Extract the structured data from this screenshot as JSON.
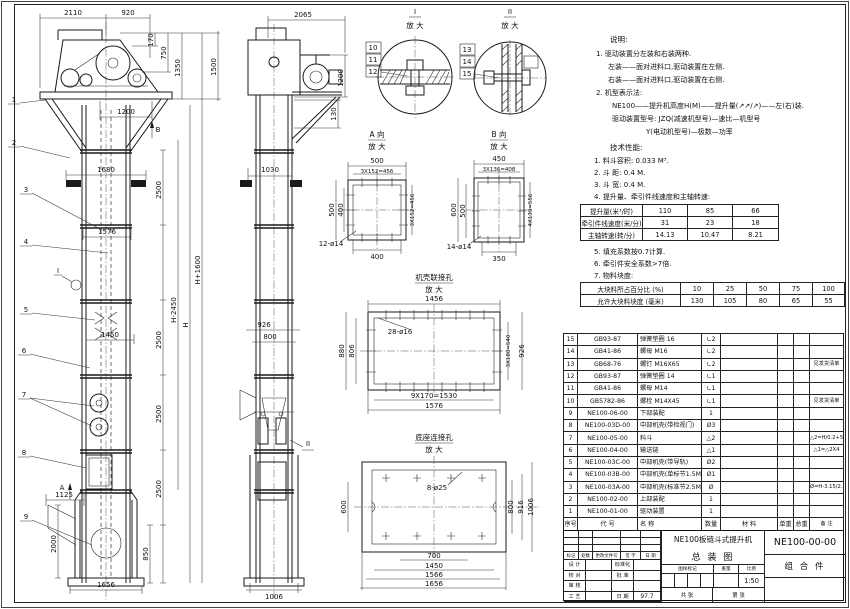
{
  "dims": {
    "d2110": "2110",
    "d920": "920",
    "d170": "170",
    "d750": "750",
    "d1350": "1350",
    "d1500": "1500",
    "d1200": "1200",
    "d1680": "1680",
    "d1576": "1576",
    "d1450": "1450",
    "d2500": "2500",
    "dHp": "H+1600",
    "dHm": "H-2450",
    "dH": "H",
    "d1125": "1125",
    "d2000": "2000",
    "d850": "850",
    "d1656": "1656",
    "d2065": "2065",
    "d130": "130",
    "d1030": "1030",
    "d926": "926",
    "d800": "800",
    "d1006": "1006",
    "d500": "500",
    "d456": "3X152=456",
    "d400": "400",
    "d12h": "12-ø14",
    "d450": "450",
    "d408": "3X136=408",
    "d600": "600",
    "d556": "4X139=556",
    "d350": "350",
    "d14h": "14-ø14",
    "d1456": "1456",
    "d28h": "28-ø16",
    "d880": "880",
    "d806": "806",
    "d540": "3X180=540",
    "d1530": "9X170=1530",
    "d8h": "8-ø25",
    "d916": "916",
    "d700": "700",
    "d1566": "1566"
  },
  "labels": {
    "enlarge": "放 大",
    "view_a": "A 向",
    "view_b": "B 向",
    "det1": "I",
    "det2": "II",
    "joint": "机壳联接孔",
    "base": "底座连接孔",
    "mark_a": "A",
    "mark_b": "B",
    "mark_i": "I",
    "mark_ii": "II"
  },
  "balloons": [
    "1",
    "2",
    "3",
    "4",
    "5",
    "6",
    "7",
    "8",
    "9",
    "10",
    "11",
    "12",
    "13",
    "14",
    "15"
  ],
  "notes": {
    "heading": "说明:",
    "lines": [
      "1. 驱动装置分左装和右装两种.",
      "左装——面对进料口,驱动装置在左侧.",
      "右装——面对进料口,驱动装置在右侧.",
      "2. 机型表示法:",
      "NE100——提升机高度H(M)——提升量(↗↗/↗)——左(右)装.",
      "驱动装置型号: JZQ(减速机型号)—速比—机型号",
      "Y(电动机型号)—极数—功率"
    ]
  },
  "tech": {
    "heading": "技术性能:",
    "items": [
      "1. 料斗容积: 0.033 M³.",
      "2. 斗  距: 0.4 M.",
      "3. 斗  宽: 0.4 M.",
      "4. 提升量、牵引件线速度和主轴转速:",
      "5. 填充系数按0.7计算.",
      "6. 牵引件安全系数>7倍.",
      "7. 物料块度:"
    ],
    "table_speed": {
      "rows": [
        [
          "提升量(米³/时)",
          "110",
          "85",
          "66"
        ],
        [
          "牵引件线速度(米/分)",
          "31",
          "23",
          "18"
        ],
        [
          "主轴转速(转/分)",
          "14.13",
          "10.47",
          "8.21"
        ]
      ]
    },
    "table_lump": {
      "rows": [
        [
          "大块料所占百分比 (%)",
          "10",
          "25",
          "50",
          "75",
          "100"
        ],
        [
          "允许大块料块度 (毫米)",
          "130",
          "105",
          "80",
          "65",
          "55"
        ]
      ]
    }
  },
  "bom": {
    "rows": [
      [
        "15",
        "GB93-87",
        "弹簧垫圈 16",
        "∟2",
        "",
        "",
        "",
        ""
      ],
      [
        "14",
        "GB41-86",
        "螺母 M16",
        "∟2",
        "",
        "",
        "",
        ""
      ],
      [
        "13",
        "GB68-76",
        "螺钉 M16X65",
        "∟2",
        "",
        "",
        "",
        "见发货清单"
      ],
      [
        "12",
        "GB93-87",
        "弹簧垫圈 14",
        "∟1",
        "",
        "",
        "",
        ""
      ],
      [
        "11",
        "GB41-86",
        "螺母 M14",
        "∟1",
        "",
        "",
        "",
        ""
      ],
      [
        "10",
        "GB5782-86",
        "螺栓 M14X45",
        "∟1",
        "",
        "",
        "",
        "见发货清单"
      ],
      [
        "9",
        "NE100-06-00",
        "下部装配",
        "1",
        "",
        "",
        "",
        ""
      ],
      [
        "8",
        "NE100-03D-00",
        "中部机壳(带检视门)",
        "Ø3",
        "",
        "",
        "",
        ""
      ],
      [
        "7",
        "NE100-05-00",
        "料斗",
        "△2",
        "",
        "",
        "",
        "△2=H/0.2+5.75"
      ],
      [
        "6",
        "NE100-04-00",
        "输送链",
        "△1",
        "",
        "",
        "",
        "△1=△2X4"
      ],
      [
        "5",
        "NE100-03C-00",
        "中部机壳(带导轨)",
        "Ø2",
        "",
        "",
        "",
        ""
      ],
      [
        "4",
        "NE100-03B-00",
        "中部机壳(单标节1.5M、1M)",
        "Ø1",
        "",
        "",
        "",
        ""
      ],
      [
        "3",
        "NE100-03A-00",
        "中部机壳(标准节2.5M)",
        "Ø",
        "",
        "",
        "",
        "Ø=H-3.15/2.5"
      ],
      [
        "2",
        "NE100-02-00",
        "上部装配",
        "1",
        "",
        "",
        "",
        ""
      ],
      [
        "1",
        "NE100-01-00",
        "驱动装置",
        "1",
        "",
        "",
        "",
        ""
      ],
      [
        "序号",
        "代  号",
        "名    称",
        "数量",
        "材  料",
        "单重",
        "总重",
        "备 注"
      ]
    ]
  },
  "title_block": {
    "product": "NE100板链斗式提升机",
    "drawing": "总  装  图",
    "code": "NE100-00-00",
    "kind": "组 合 件",
    "scale": "1:50",
    "date": "97.7",
    "labels": {
      "mark": "标记",
      "qty": "处数",
      "file": "更改文件号",
      "sign": "签 字",
      "date": "日 期",
      "design": "设 计",
      "check": "校 对",
      "audit": "审 核",
      "craft": "工 艺",
      "std": "标准化",
      "approve": "批 准",
      "date2": "日 期",
      "stamp": "图样标记",
      "weight": "重量",
      "scale": "比例",
      "total": "共  张",
      "page": "第  张"
    }
  }
}
